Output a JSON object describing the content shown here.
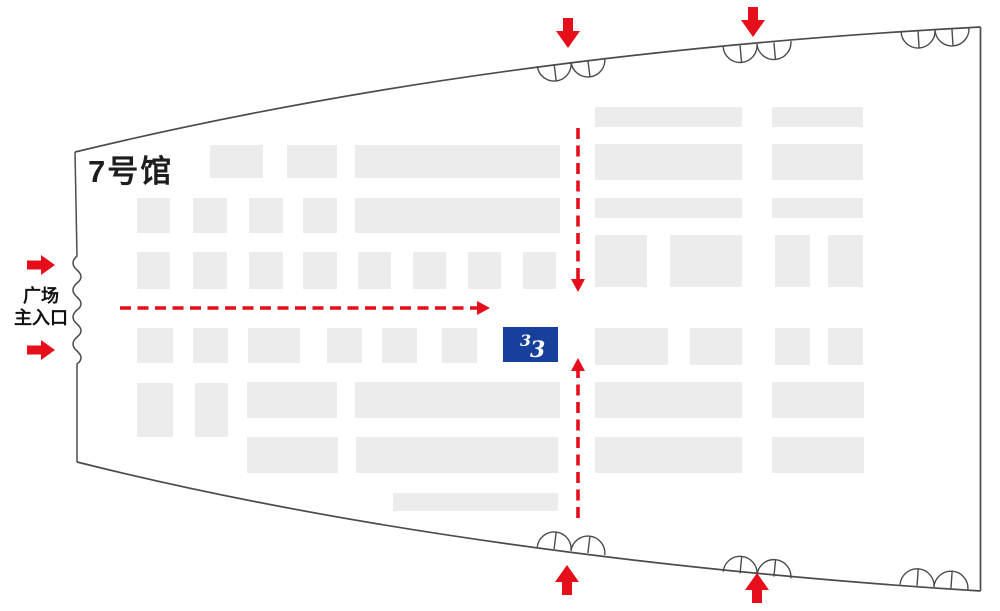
{
  "hall": {
    "label": "7号馆"
  },
  "entrance": {
    "line1": "广场",
    "line2": "主入口"
  },
  "colors": {
    "background": "#ffffff",
    "wall": "#4b4b4d",
    "booth": "#ececec",
    "red": "#e60e1a",
    "blue": "#16409b",
    "logo": "#ffffff",
    "text": "#1d1d1f"
  },
  "booths": [
    [
      210,
      145,
      53,
      33
    ],
    [
      287,
      145,
      50,
      33
    ],
    [
      355,
      145,
      205,
      33
    ],
    [
      137,
      198,
      33,
      35
    ],
    [
      193,
      198,
      34,
      35
    ],
    [
      249,
      198,
      34,
      35
    ],
    [
      303,
      198,
      34,
      35
    ],
    [
      355,
      198,
      205,
      35
    ],
    [
      137,
      252,
      33,
      37
    ],
    [
      193,
      252,
      34,
      37
    ],
    [
      249,
      252,
      34,
      37
    ],
    [
      303,
      252,
      34,
      37
    ],
    [
      358,
      252,
      33,
      37
    ],
    [
      413,
      252,
      33,
      37
    ],
    [
      468,
      252,
      33,
      37
    ],
    [
      523,
      252,
      33,
      37
    ],
    [
      137,
      328,
      36,
      35
    ],
    [
      193,
      328,
      35,
      35
    ],
    [
      248,
      328,
      52,
      35
    ],
    [
      327,
      328,
      35,
      35
    ],
    [
      382,
      328,
      35,
      35
    ],
    [
      442,
      328,
      35,
      35
    ],
    [
      137,
      383,
      36,
      54
    ],
    [
      195,
      383,
      33,
      54
    ],
    [
      247,
      382,
      90,
      36
    ],
    [
      355,
      382,
      205,
      36
    ],
    [
      247,
      437,
      91,
      36
    ],
    [
      356,
      437,
      202,
      36
    ],
    [
      393,
      493,
      165,
      18
    ],
    [
      595,
      107,
      147,
      20
    ],
    [
      772,
      107,
      91,
      20
    ],
    [
      595,
      144,
      147,
      36
    ],
    [
      772,
      144,
      91,
      36
    ],
    [
      595,
      198,
      147,
      20
    ],
    [
      772,
      198,
      91,
      20
    ],
    [
      595,
      235,
      52,
      52
    ],
    [
      670,
      235,
      72,
      52
    ],
    [
      775,
      235,
      35,
      52
    ],
    [
      828,
      235,
      35,
      52
    ],
    [
      595,
      328,
      73,
      37
    ],
    [
      690,
      328,
      52,
      37
    ],
    [
      775,
      328,
      35,
      37
    ],
    [
      828,
      328,
      35,
      37
    ],
    [
      595,
      382,
      147,
      36
    ],
    [
      772,
      382,
      92,
      36
    ],
    [
      595,
      437,
      147,
      36
    ],
    [
      772,
      437,
      92,
      36
    ]
  ],
  "brand_booth": {
    "x": 503,
    "y": 327,
    "w": 55,
    "h": 35,
    "icon": "double-3-swoosh-logo",
    "logo_glyphs": [
      {
        "char": "3",
        "dx": 17,
        "dy": 19,
        "size": 16
      },
      {
        "char": "3",
        "dx": 27,
        "dy": 30,
        "size": 22
      }
    ]
  },
  "doors": [
    {
      "name": "top-gate-door-left",
      "cx": 571,
      "cy": 62,
      "rot": -7,
      "side": "top"
    },
    {
      "name": "top-gate-door-right",
      "cx": 757,
      "cy": 44,
      "rot": -5,
      "side": "top"
    },
    {
      "name": "top-gate-door-corner",
      "cx": 935,
      "cy": 30,
      "rot": -3.5,
      "side": "top"
    },
    {
      "name": "bottom-gate-door-left",
      "cx": 571,
      "cy": 551,
      "rot": 7,
      "side": "bottom"
    },
    {
      "name": "bottom-gate-door-right",
      "cx": 757,
      "cy": 575,
      "rot": 5.5,
      "side": "bottom"
    },
    {
      "name": "bottom-gate-door-corner",
      "cx": 934,
      "cy": 587,
      "rot": 4,
      "side": "bottom"
    }
  ],
  "solid_arrows": [
    {
      "name": "plaza-entrance-arrow-upper",
      "x": 41,
      "y": 265,
      "dir": "right"
    },
    {
      "name": "plaza-entrance-arrow-lower",
      "x": 41,
      "y": 350,
      "dir": "right"
    },
    {
      "name": "top-gate-arrow-left",
      "x": 568,
      "y": 33,
      "dir": "down"
    },
    {
      "name": "top-gate-arrow-right",
      "x": 753,
      "y": 22,
      "dir": "down"
    },
    {
      "name": "bottom-gate-arrow-left",
      "x": 567,
      "y": 580,
      "dir": "up"
    },
    {
      "name": "bottom-gate-arrow-right",
      "x": 757,
      "y": 588,
      "dir": "up"
    }
  ],
  "dashed_routes": [
    {
      "name": "route-from-main-entrance-horizontal",
      "x1": 120,
      "y1": 308,
      "x2": 477,
      "y2": 308,
      "tipx": 490,
      "tipy": 308,
      "dir": "right"
    },
    {
      "name": "route-from-top-gate-vertical",
      "x1": 578,
      "y1": 128,
      "x2": 578,
      "y2": 279,
      "tipx": 578,
      "tipy": 292,
      "dir": "down"
    },
    {
      "name": "route-from-bottom-gate-vertical",
      "x1": 578,
      "y1": 518,
      "x2": 578,
      "y2": 371,
      "tipx": 578,
      "tipy": 358,
      "dir": "up"
    }
  ]
}
